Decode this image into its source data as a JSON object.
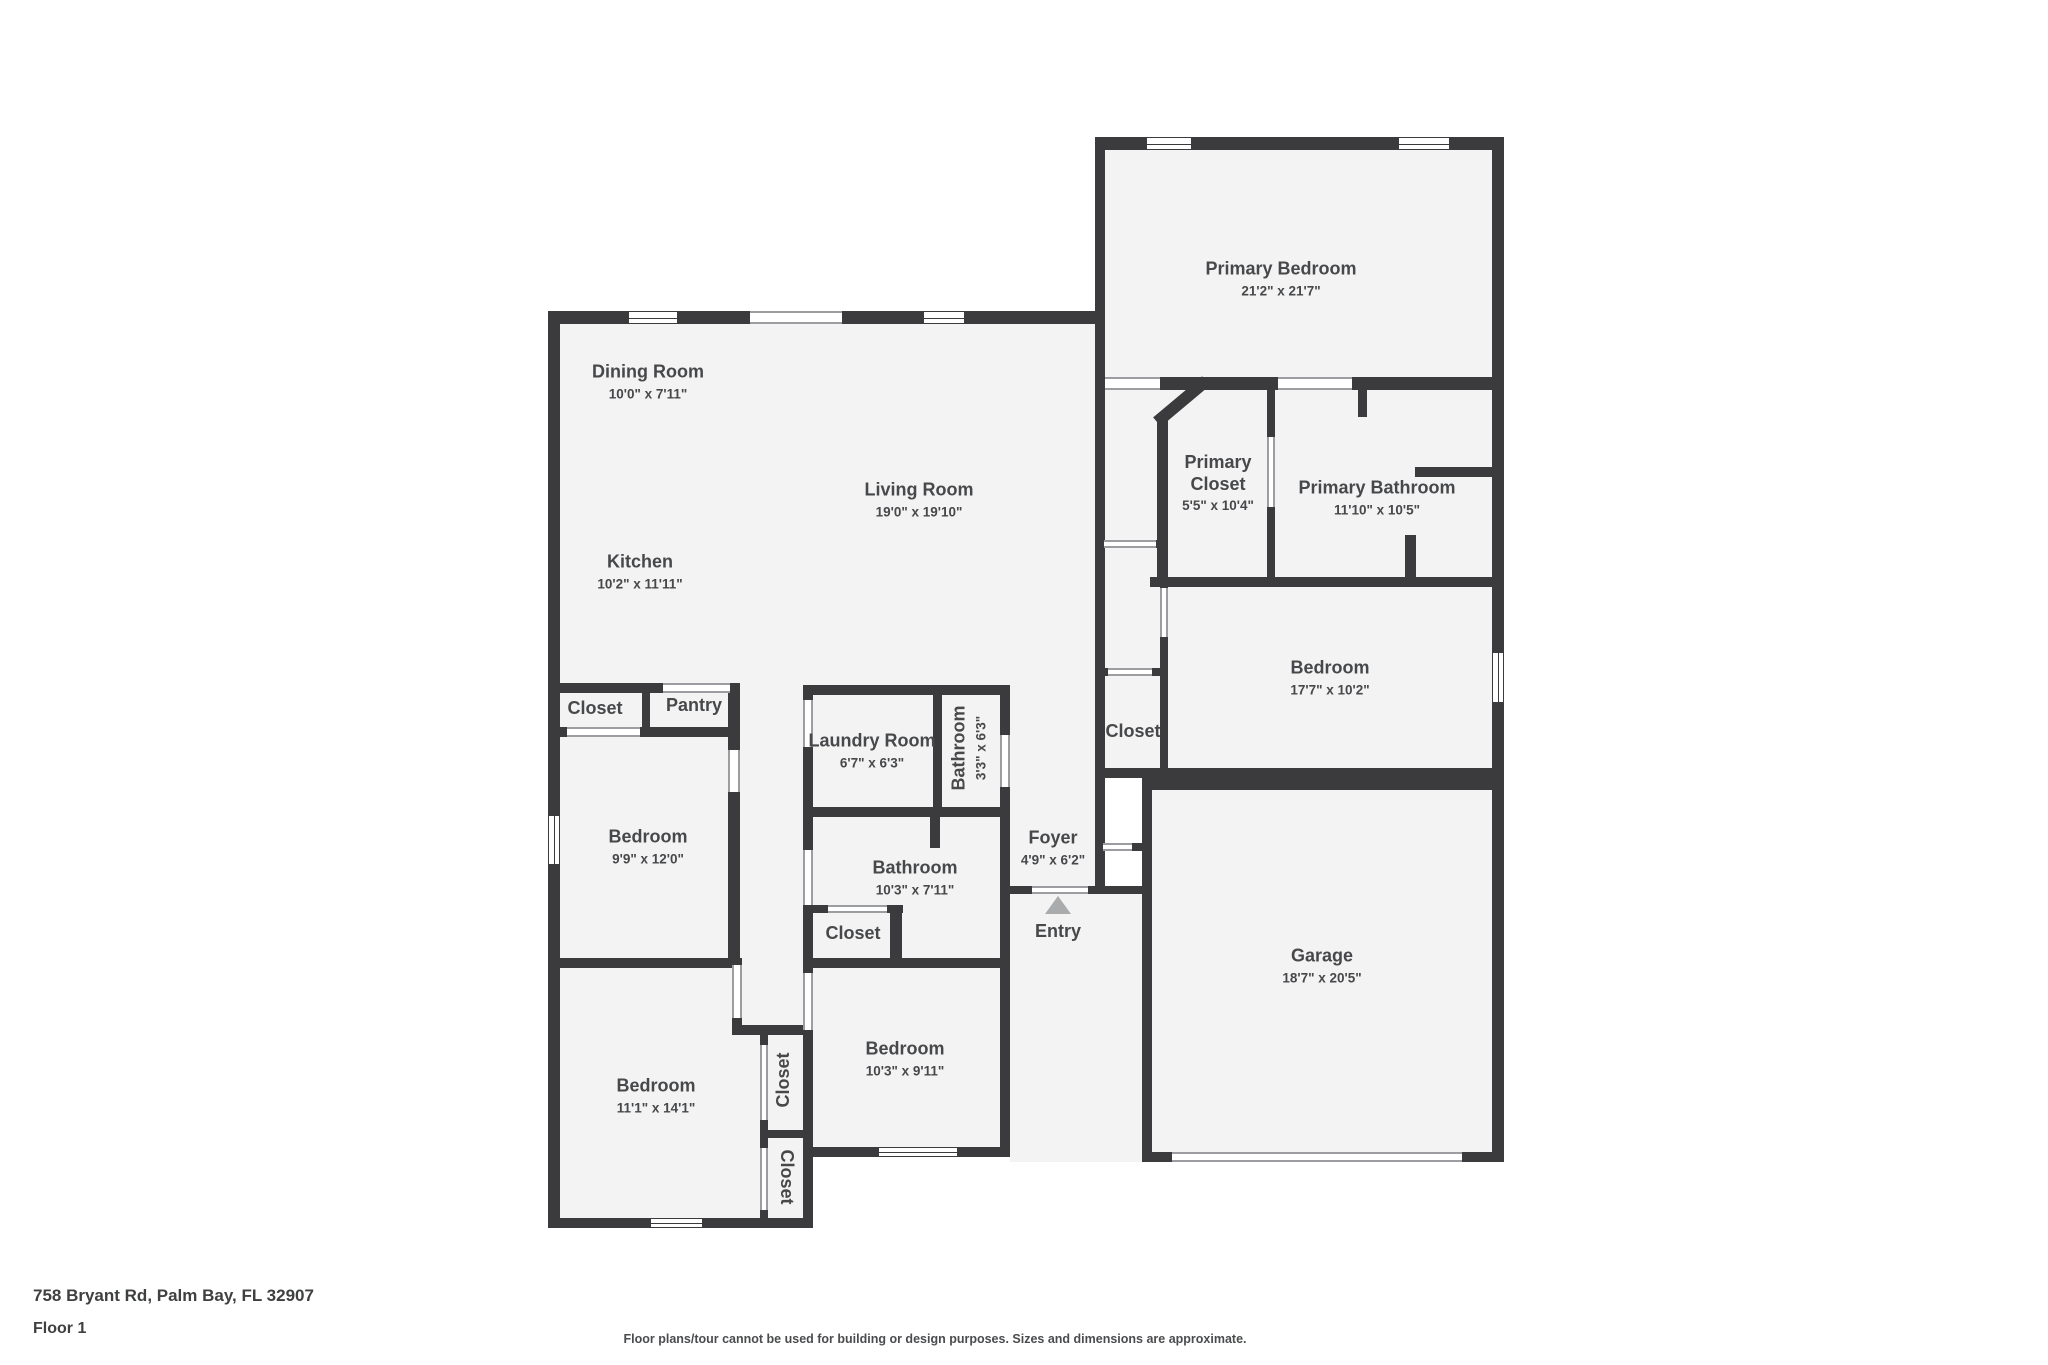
{
  "floorplan": {
    "address": "758 Bryant Rd, Palm Bay, FL 32907",
    "floor_label": "Floor 1",
    "disclaimer": "Floor plans/tour cannot be used for building or design purposes. Sizes and dimensions are approximate.",
    "entry_label": "Entry",
    "colors": {
      "wall": "#3b3b3d",
      "room_fill": "#f3f3f4",
      "background": "#ffffff",
      "text": "#47484a",
      "entry_arrow": "#a9abad"
    },
    "rooms": [
      {
        "name": "Primary Bedroom",
        "dims": "21'2\" x 21'7\""
      },
      {
        "name": "Dining Room",
        "dims": "10'0\" x 7'11\""
      },
      {
        "name": "Living Room",
        "dims": "19'0\" x 19'10\""
      },
      {
        "name": "Kitchen",
        "dims": "10'2\" x 11'11\""
      },
      {
        "name": "Primary Closet",
        "dims": "5'5\" x 10'4\""
      },
      {
        "name": "Primary Bathroom",
        "dims": "11'10\" x 10'5\""
      },
      {
        "name": "Bedroom",
        "dims": "17'7\" x 10'2\""
      },
      {
        "name": "Closet",
        "dims": ""
      },
      {
        "name": "Pantry",
        "dims": ""
      },
      {
        "name": "Laundry Room",
        "dims": "6'7\" x 6'3\""
      },
      {
        "name": "Bathroom",
        "dims": "3'3\" x 6'3\""
      },
      {
        "name": "Closet",
        "dims": ""
      },
      {
        "name": "Bedroom",
        "dims": "9'9\" x 12'0\""
      },
      {
        "name": "Foyer",
        "dims": "4'9\" x 6'2\""
      },
      {
        "name": "Bathroom",
        "dims": "10'3\" x 7'11\""
      },
      {
        "name": "Closet",
        "dims": ""
      },
      {
        "name": "Garage",
        "dims": "18'7\" x 20'5\""
      },
      {
        "name": "Bedroom",
        "dims": "10'3\" x 9'11\""
      },
      {
        "name": "Bedroom",
        "dims": "11'1\" x 14'1\""
      },
      {
        "name": "Closet",
        "dims": ""
      },
      {
        "name": "Closet",
        "dims": ""
      }
    ]
  }
}
